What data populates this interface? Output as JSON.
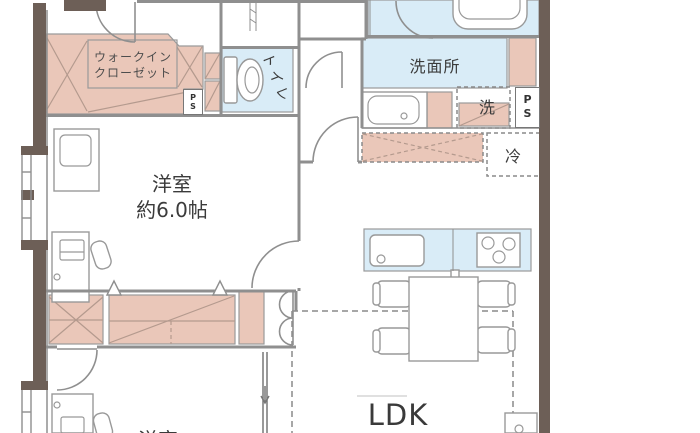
{
  "colors": {
    "wall": "#6d5f57",
    "line": "#8f8f8f",
    "pink": "#eac7b9",
    "blue": "#d9ecf7",
    "text": "#3b3b3b"
  },
  "rooms": {
    "walk_in_closet": {
      "line1": "ウォークイン",
      "line2": "クローゼット"
    },
    "toilet": {
      "label": "トイレ"
    },
    "washroom": {
      "label": "洗面所"
    },
    "bedroom": {
      "label": "洋室",
      "size": "約6.0帖"
    },
    "bedroom2": {
      "label": "洋室"
    },
    "ldk": {
      "label": "LDK"
    }
  },
  "fixtures": {
    "washing_machine": {
      "label": "洗"
    },
    "refrigerator": {
      "label": "冷"
    },
    "pipe_space": {
      "top": "P",
      "bottom": "S"
    }
  }
}
